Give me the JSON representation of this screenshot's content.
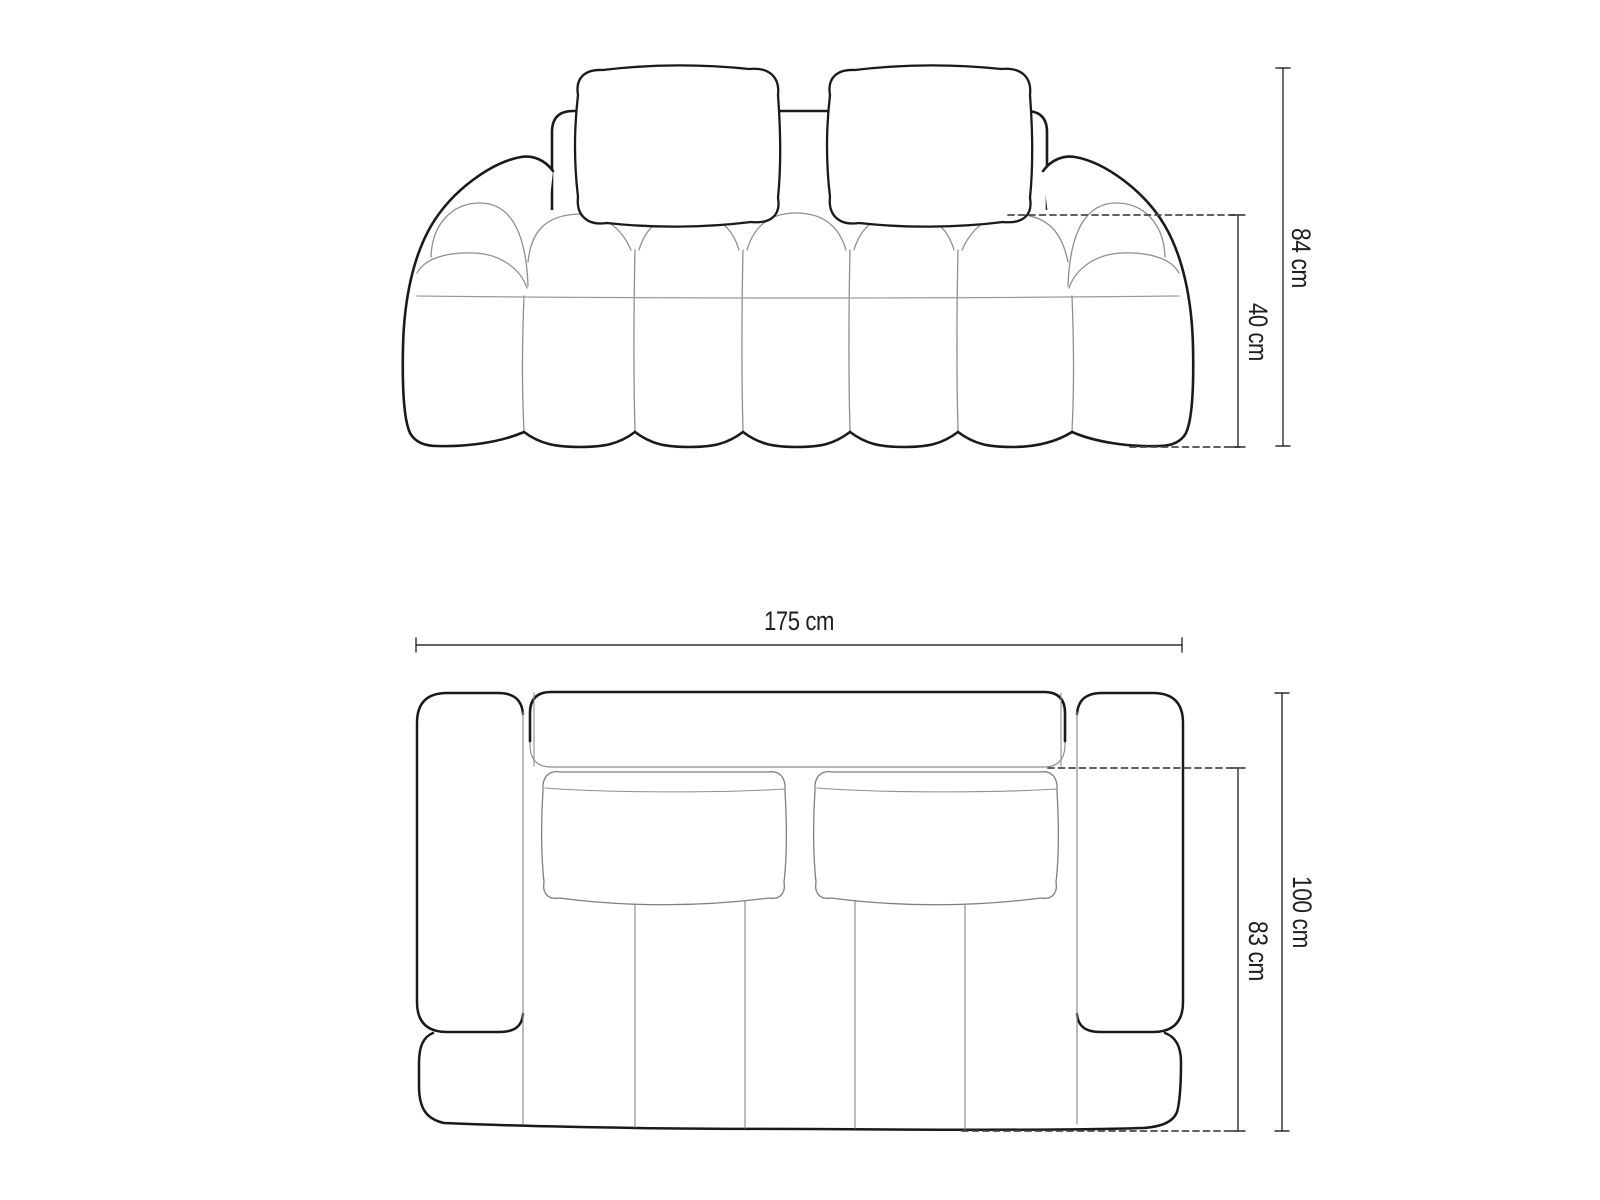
{
  "diagram": {
    "subject": "sofa-technical-dimension-drawing",
    "views": {
      "front_view": {
        "name": "front elevation",
        "dimensions": {
          "overall_height": "84 cm",
          "seat_height": "40 cm"
        }
      },
      "top_view": {
        "name": "top plan",
        "dimensions": {
          "overall_width": "175 cm",
          "overall_depth": "100 cm",
          "seat_depth": "83 cm"
        }
      }
    },
    "colors": {
      "background": "#ffffff",
      "outline": "#1a1a1a",
      "seam": "#8f8f8f",
      "dimension_line": "#2f2f2f",
      "dashed_line": "#4a4a4a"
    }
  }
}
